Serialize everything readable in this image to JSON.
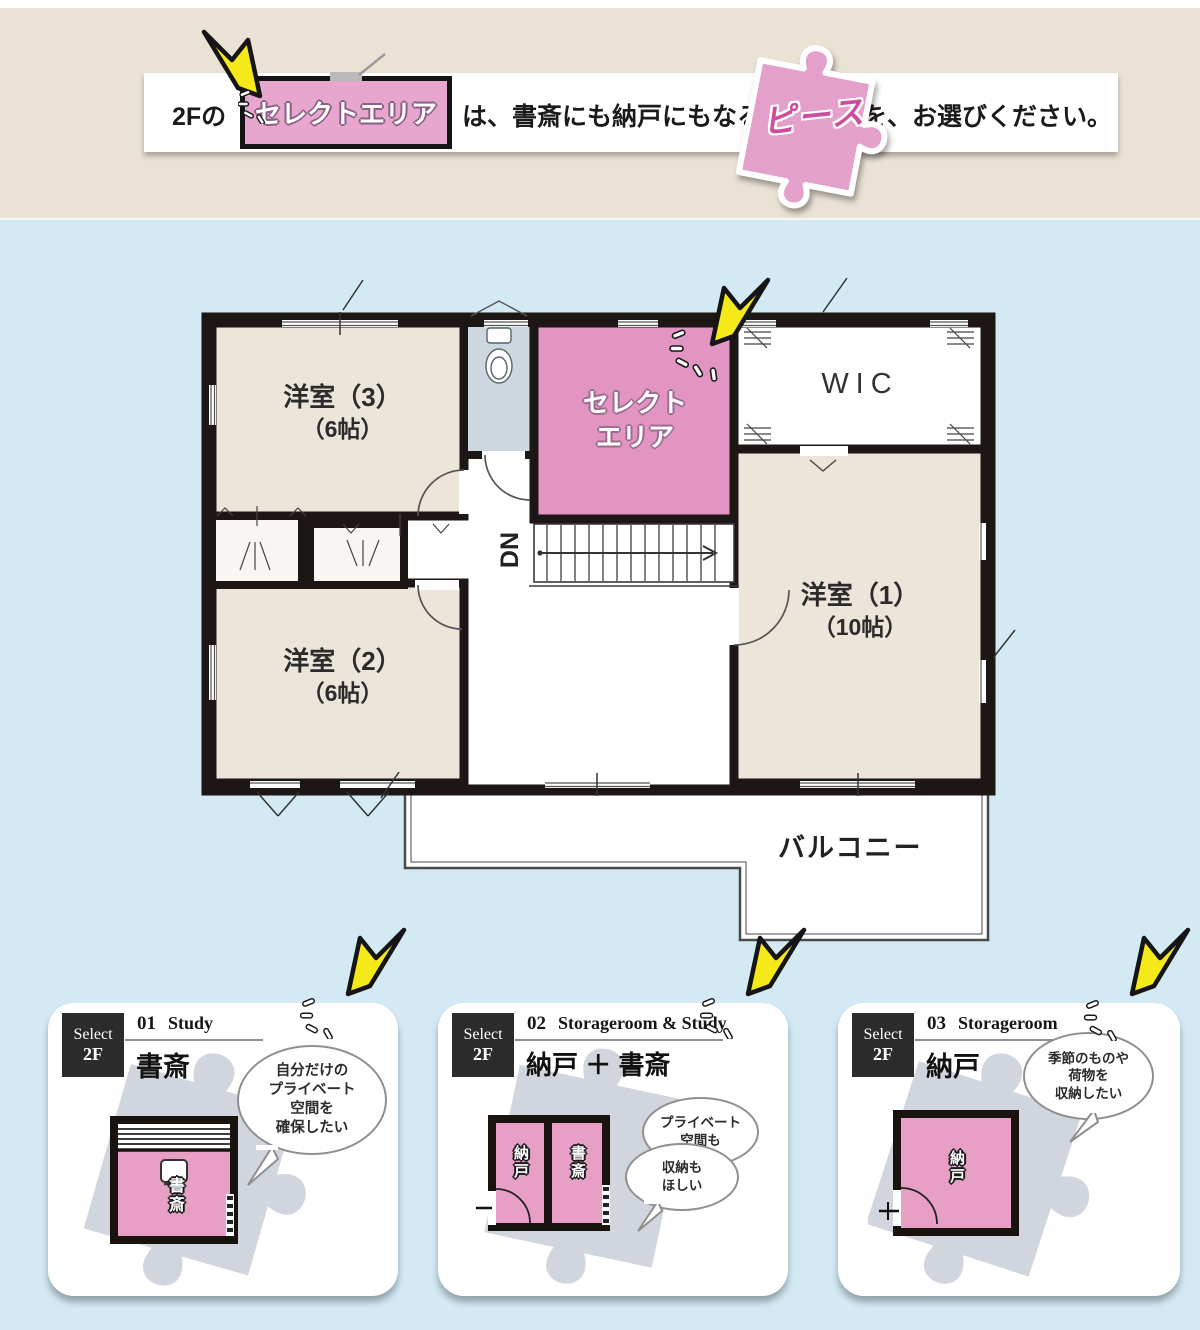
{
  "banner": {
    "prefix": "2Fの",
    "select_box": "セレクトエリア",
    "middle": "は、書斎にも納戸にもなる",
    "piece_word": "ピース",
    "suffix": "を、お選びください。"
  },
  "floorplan": {
    "rooms": {
      "yoshitsu3": {
        "label": "洋室（3）",
        "size": "（6帖）"
      },
      "select_area": {
        "line1": "セレクト",
        "line2": "エリア"
      },
      "wic": {
        "label": "WIC"
      },
      "yoshitsu1": {
        "label": "洋室（1）",
        "size": "（10帖）"
      },
      "yoshitsu2": {
        "label": "洋室（2）",
        "size": "（6帖）"
      },
      "stairs": {
        "label": "DN"
      },
      "balcony": {
        "label": "バルコニー"
      }
    }
  },
  "cards": [
    {
      "select_label": "Select",
      "floor": "2F",
      "number": "01",
      "title_en": "Study",
      "title_jp": "書斎",
      "bubbles": [
        {
          "lines": [
            "自分だけの",
            "プライベート",
            "空間を",
            "確保したい"
          ]
        }
      ],
      "plan_rooms": [
        {
          "label": "書斎"
        }
      ]
    },
    {
      "select_label": "Select",
      "floor": "2F",
      "number": "02",
      "title_en": "Storageroom & Study",
      "title_jp": "納戸 ＋ 書斎",
      "bubbles": [
        {
          "lines": [
            "プライベート",
            "空間も"
          ]
        },
        {
          "lines": [
            "収納も",
            "ほしい"
          ]
        }
      ],
      "plan_rooms": [
        {
          "label": "納戸"
        },
        {
          "label": "書斎"
        }
      ]
    },
    {
      "select_label": "Select",
      "floor": "2F",
      "number": "03",
      "title_en": "Storageroom",
      "title_jp": "納戸",
      "bubbles": [
        {
          "lines": [
            "季節のものや",
            "荷物を",
            "収納したい"
          ]
        }
      ],
      "plan_rooms": [
        {
          "label": "納戸"
        }
      ]
    }
  ],
  "colors": {
    "background_blue": "#d3e9f4",
    "banner_beige": "#e9e2d5",
    "accent_pink": "#e295c2",
    "pink_light": "#e7a6cd",
    "pink_text": "#cb4d9d",
    "room_beige": "#ece5da",
    "toilet_blue": "#ccd7df",
    "wall_black": "#1c1614",
    "arrow_yellow": "#f6e919",
    "puzzle_gray": "#c5cad6"
  }
}
